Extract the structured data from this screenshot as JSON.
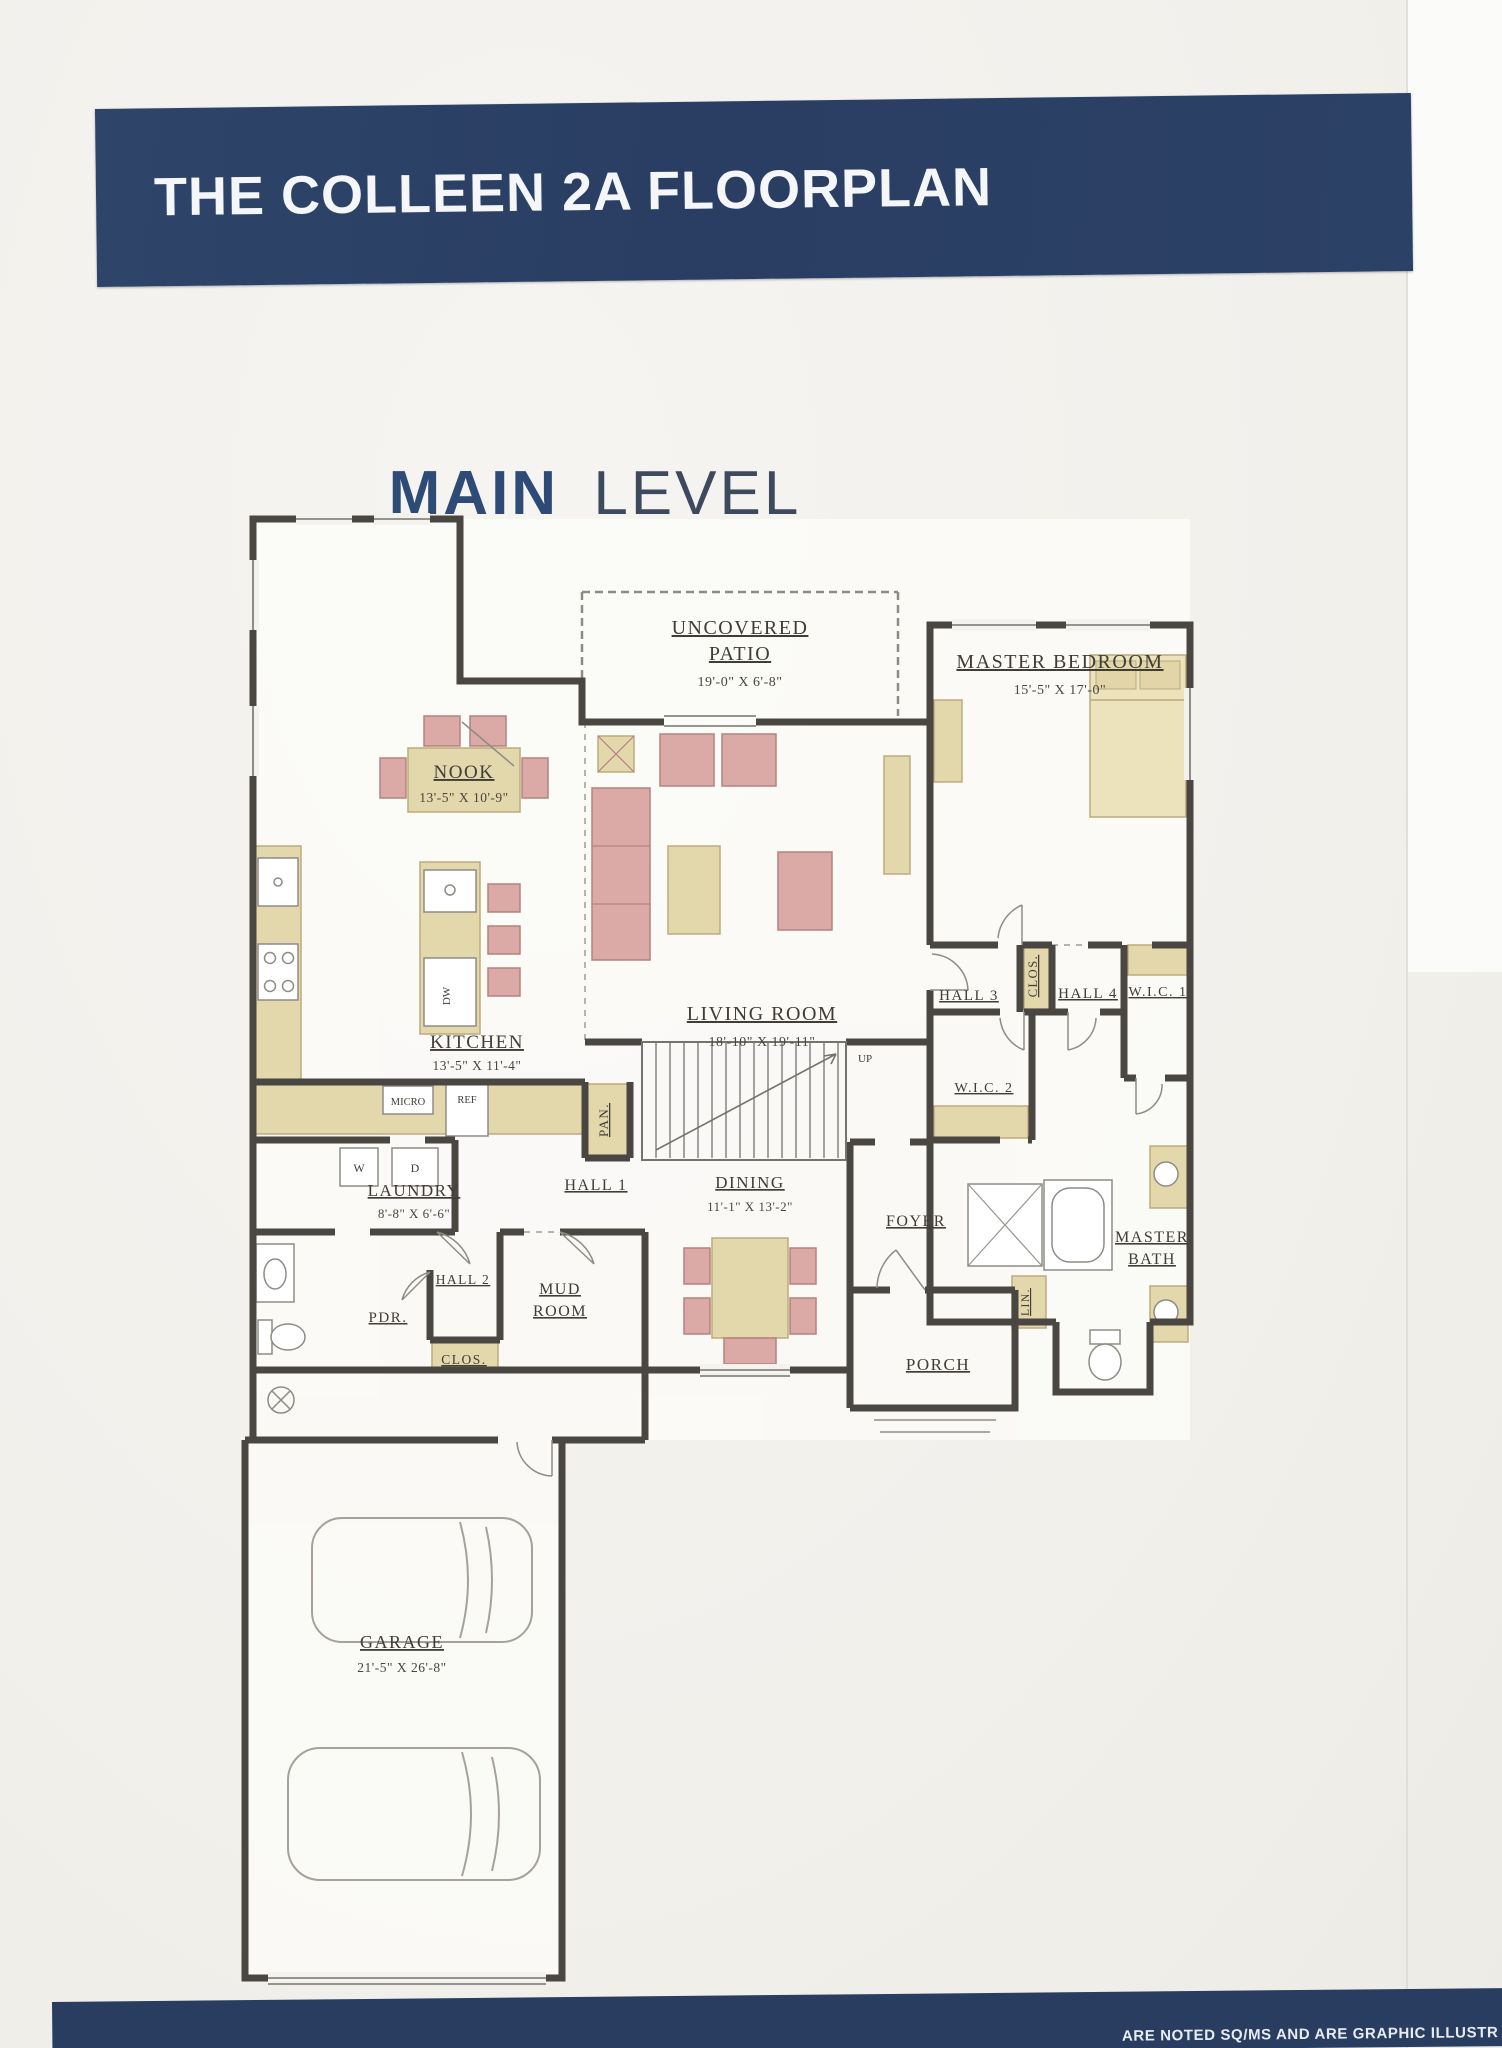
{
  "header": {
    "title": "THE COLLEEN 2A FLOORPLAN"
  },
  "page_title": {
    "word1": "MAIN",
    "word2": "LEVEL"
  },
  "footer": {
    "fragment": "ARE NOTED SQ/MS AND ARE GRAPHIC ILLUSTR"
  },
  "colors": {
    "banner_navy": "#2b4066",
    "title_blue": "#2e4a77",
    "title_slate": "#3d4a5e",
    "wall": "#4a4641",
    "label_ink": "#403c36",
    "tan": "#e3d7ac",
    "pink": "#dcaaa6",
    "cream": "#ece3bd"
  },
  "plan": {
    "uncovered_patio": {
      "l1": "UNCOVERED",
      "l2": "PATIO",
      "dims": "19'-0\" X 6'-8\""
    },
    "master_bedroom": {
      "name": "MASTER BEDROOM",
      "dims": "15'-5\" X 17'-0\""
    },
    "nook": {
      "name": "NOOK",
      "dims": "13'-5\" X 10'-9\""
    },
    "kitchen": {
      "name": "KITCHEN",
      "dims": "13'-5\" X 11'-4\""
    },
    "living_room": {
      "name": "LIVING ROOM",
      "dims": "18'-10\" X 19'-11\""
    },
    "laundry": {
      "name": "LAUNDRY",
      "dims": "8'-8\" X 6'-6\""
    },
    "dining": {
      "name": "DINING",
      "dims": "11'-1\" X 13'-2\""
    },
    "garage": {
      "name": "GARAGE",
      "dims": "21'-5\" X 26'-8\""
    },
    "master_bath": {
      "l1": "MASTER",
      "l2": "BATH"
    },
    "mud_room": {
      "l1": "MUD",
      "l2": "ROOM"
    },
    "hall1": {
      "name": "HALL 1"
    },
    "hall2": {
      "name": "HALL 2"
    },
    "hall3": {
      "name": "HALL 3"
    },
    "hall4": {
      "name": "HALL 4"
    },
    "wic1": {
      "name": "W.I.C. 1"
    },
    "wic2": {
      "name": "W.I.C. 2"
    },
    "clos_hall": {
      "name": "CLOS."
    },
    "clos_mud": {
      "name": "CLOS."
    },
    "pan": {
      "name": "PAN."
    },
    "lin": {
      "name": "LIN."
    },
    "pdr": {
      "name": "PDR."
    },
    "foyer": {
      "name": "FOYER"
    },
    "porch": {
      "name": "PORCH"
    },
    "up": {
      "name": "UP"
    },
    "appliances": {
      "dw": "DW",
      "micro": "MICRO",
      "ref": "REF",
      "washer": "W",
      "dryer": "D"
    }
  }
}
